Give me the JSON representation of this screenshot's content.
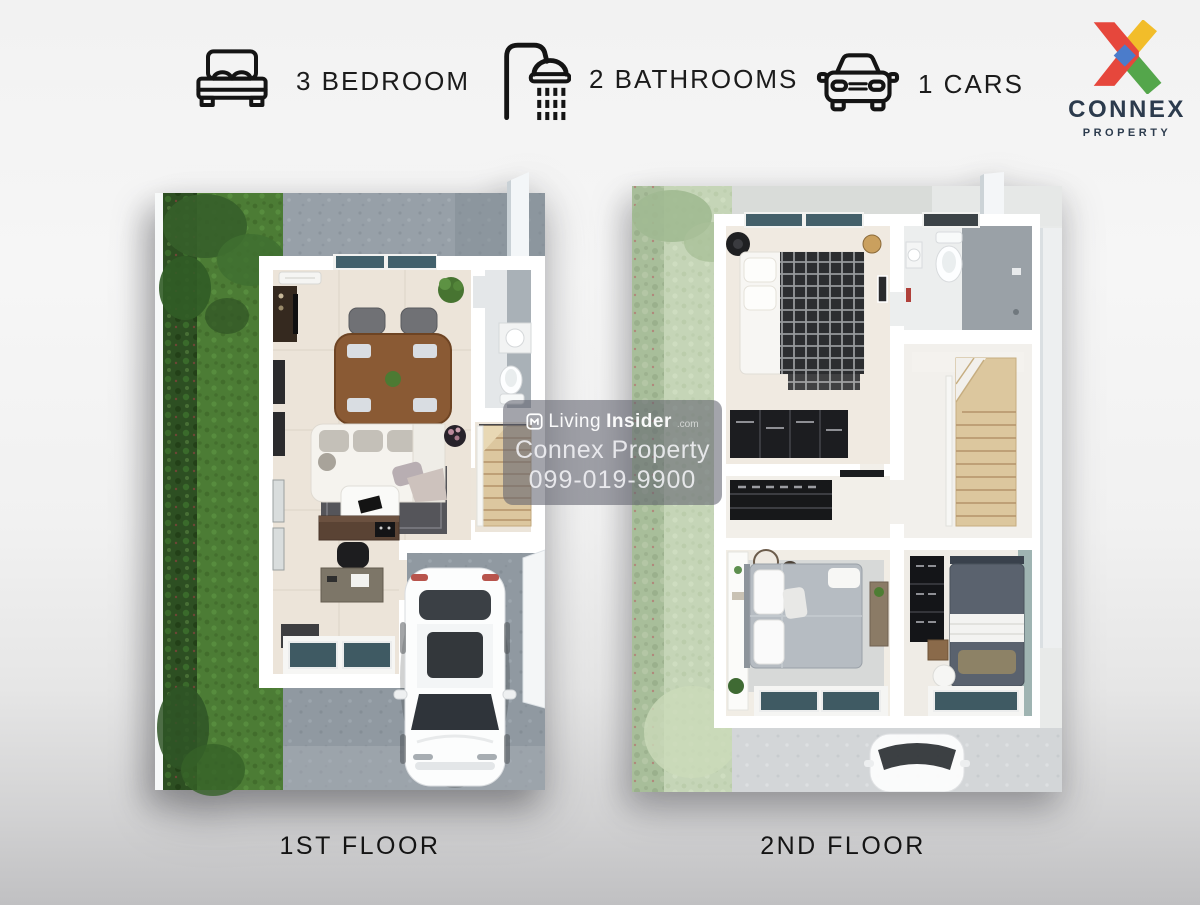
{
  "header": {
    "features": [
      {
        "icon": "bed-icon",
        "label": "3 BEDROOM"
      },
      {
        "icon": "shower-icon",
        "label": "2 BATHROOMS"
      },
      {
        "icon": "car-icon",
        "label": "1 CARS"
      }
    ],
    "logo": {
      "name": "CONNEX",
      "tagline": "PROPERTY",
      "colors": {
        "red": "#e6473c",
        "yellow": "#f2bd2a",
        "green": "#54a64b",
        "blue": "#4b7ccb",
        "navy": "#2c3b4d"
      }
    }
  },
  "watermark": {
    "site_light": "Living",
    "site_bold": "Insider",
    "site_suffix": ".com",
    "line2": "Connex Property",
    "line3": "099-019-9900"
  },
  "floors": [
    {
      "label": "1ST FLOOR"
    },
    {
      "label": "2ND FLOOR"
    }
  ]
}
